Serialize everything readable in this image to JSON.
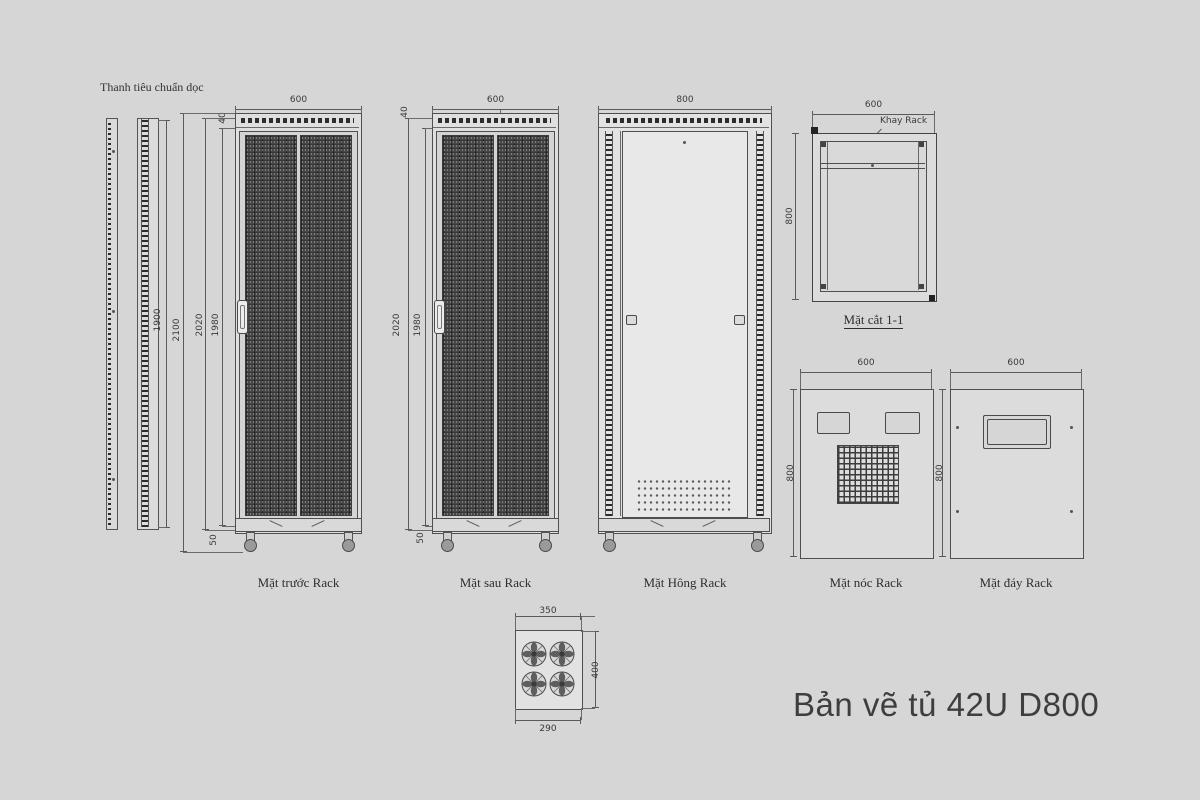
{
  "title": "Bản vẽ tủ 42U D800",
  "rail": {
    "label": "Thanh tiêu chuẩn dọc",
    "length": "1900"
  },
  "front": {
    "label": "Mặt trước Rack",
    "width": "600",
    "overall": "2100",
    "body": "2020",
    "frame": "1980",
    "cap": "40",
    "caster": "50"
  },
  "back": {
    "label": "Mặt sau Rack",
    "width": "600",
    "body": "2020",
    "frame": "1980",
    "cap": "40",
    "caster": "50"
  },
  "side": {
    "label": "Mặt Hông Rack",
    "depth": "800"
  },
  "section": {
    "label": "Mặt cắt 1-1",
    "width": "600",
    "depth": "800",
    "callout": "Khay Rack"
  },
  "top": {
    "label": "Mặt nóc Rack",
    "width": "600",
    "depth": "800"
  },
  "bottom": {
    "label": "Mặt đáy Rack",
    "width": "600",
    "depth": "800"
  },
  "fan": {
    "width": "350",
    "height": "400",
    "inner": "290"
  },
  "colors": {
    "background": "#d6d6d6",
    "line": "#4f4f4f",
    "mesh": "#383838",
    "text": "#3a3a3a"
  }
}
